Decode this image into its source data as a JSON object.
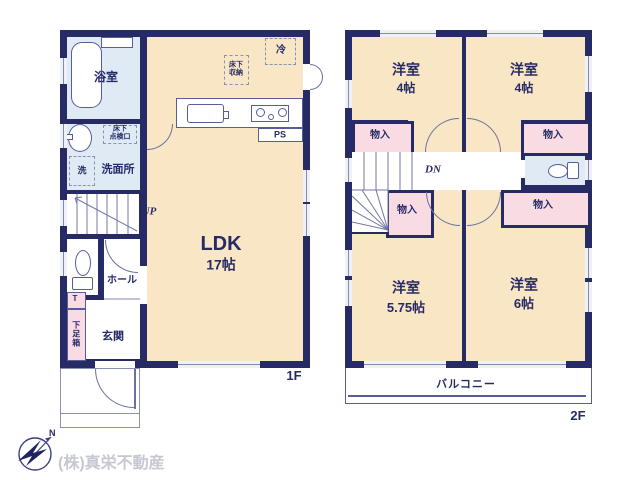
{
  "company": "(株)真栄不動産",
  "compass": {
    "north": "N"
  },
  "colors": {
    "wall": "#262b66",
    "room_cream": "#f9e6c5",
    "wet_area_blue": "#dfeaf4",
    "closet_pink": "#f9dbe4",
    "line": "#6b71a3",
    "company_gray": "#c7c8d2"
  },
  "floor1": {
    "floor_label": "1F",
    "bathroom": "浴室",
    "washroom": "洗面所",
    "washer": "洗",
    "underfloor_access": "床下\n点検口",
    "up": "UP",
    "hall": "ホール",
    "shoe_t": "T",
    "shoe_box": "下足箱",
    "entrance": "玄関",
    "ldk_name": "LDK",
    "ldk_size": "17帖",
    "fridge": "冷",
    "underfloor_storage": "床下\n収納",
    "ps": "PS"
  },
  "floor2": {
    "floor_label": "2F",
    "bedroom1_name": "洋室",
    "bedroom1_size": "4帖",
    "bedroom2_name": "洋室",
    "bedroom2_size": "4帖",
    "bedroom3_name": "洋室",
    "bedroom3_size": "5.75帖",
    "bedroom4_name": "洋室",
    "bedroom4_size": "6帖",
    "closet1": "物入",
    "closet2": "物入",
    "closet3": "物入",
    "closet4": "物入",
    "dn": "DN",
    "toilet": "",
    "balcony": "バルコニー"
  }
}
